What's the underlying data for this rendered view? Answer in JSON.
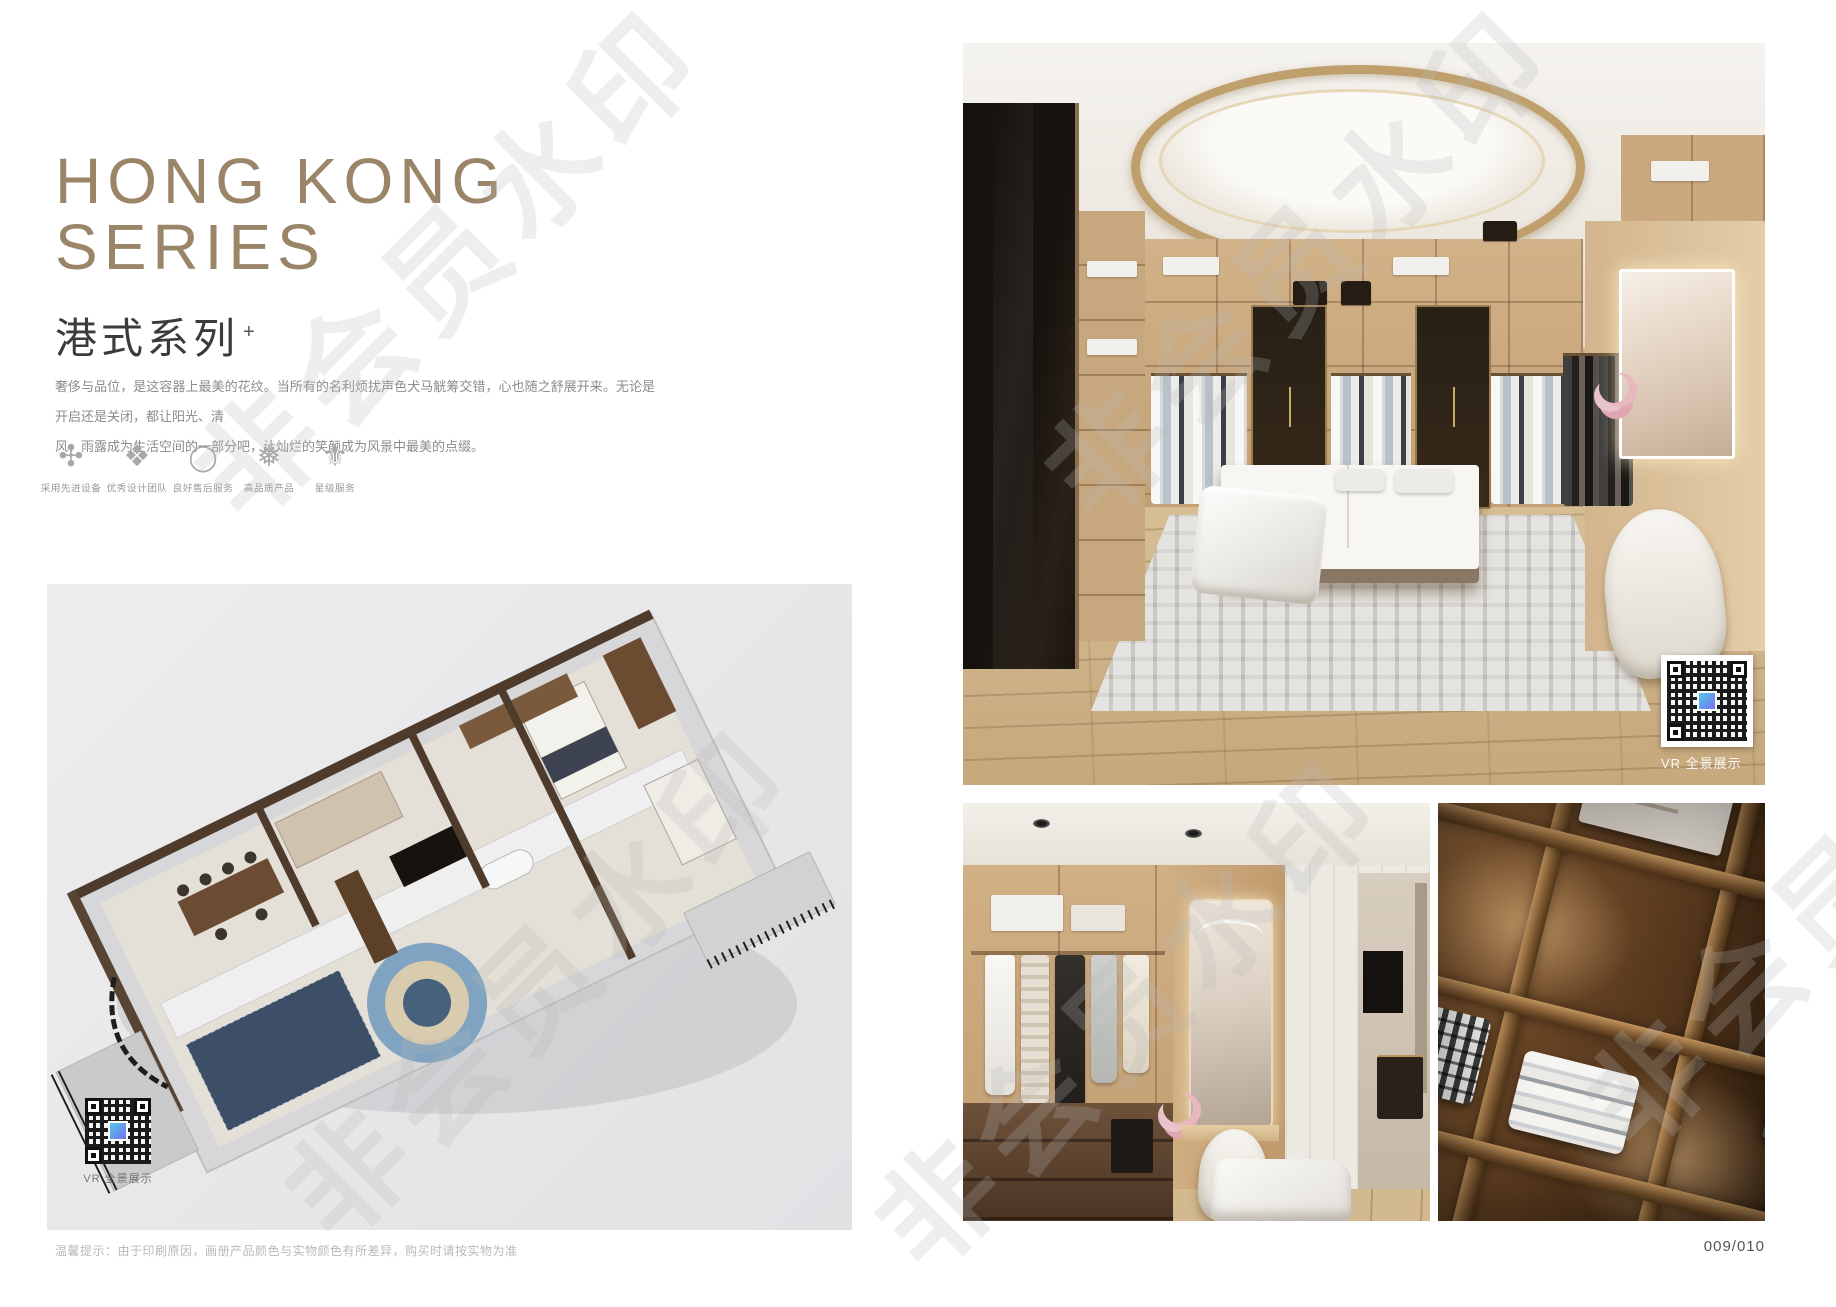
{
  "header": {
    "title_line1": "HONG KONG",
    "title_line2": "SERIES",
    "subtitle_cn": "港式系列",
    "subtitle_mark": "+",
    "desc_line1": "奢侈与品位，是这容器上最美的花纹。当所有的名利烦扰声色犬马觥筹交错，心也随之舒展开来。无论是开启还是关闭，都让阳光、清",
    "desc_line2": "风、雨露成为生活空间的一部分吧，让灿烂的笑颜成为风景中最美的点缀。"
  },
  "features": [
    {
      "icon": "pinwheel-flower-icon",
      "glyph": "✣",
      "label": "采用先进设备"
    },
    {
      "icon": "diamond-ornament-icon",
      "glyph": "❖",
      "label": "优秀设计团队"
    },
    {
      "icon": "enso-ring-icon",
      "glyph": "◯",
      "label": "良好售后服务"
    },
    {
      "icon": "snowflake-icon",
      "glyph": "❅",
      "label": "高品质产品"
    },
    {
      "icon": "fleur-ornament-icon",
      "glyph": "⚜",
      "label": "星级服务"
    }
  ],
  "floorplan": {
    "vr_label": "VR 全景展示"
  },
  "main_photo": {
    "vr_label": "VR 全景展示"
  },
  "footer": {
    "note": "温馨提示：由于印刷原因，画册产品颜色与实物颜色有所差异，购买时请按实物为准",
    "page_number": "009/010"
  },
  "watermark": {
    "text": "非会员水印"
  },
  "colors": {
    "title_gold": "#9b8568",
    "subtitle_dark": "#3b3b3b",
    "body_gray": "#8c8c8c",
    "panel_gray": "#e9e9ea",
    "note_gray": "#b9b9b9"
  }
}
